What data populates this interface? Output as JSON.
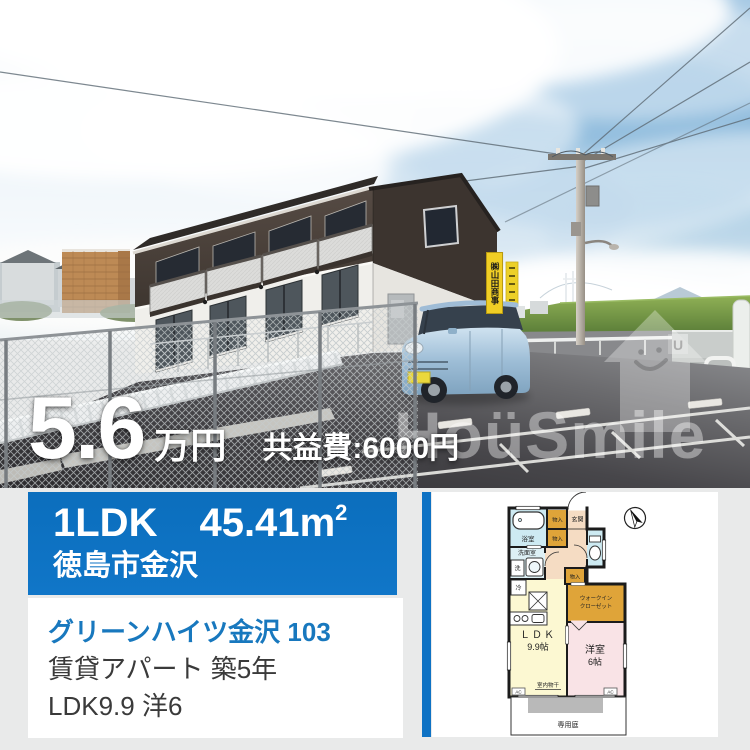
{
  "photo": {
    "price_value": "5.6",
    "price_unit": "万円",
    "fee_text": "共益費:6000円",
    "watermark_text": "HoüSmile",
    "watermark_logo_letter": "U",
    "sign_text": "㈱山田商事"
  },
  "info_box": {
    "layout": "1LDK",
    "area_value": "45.41",
    "area_unit_base": "m",
    "area_unit_sup": "2",
    "location": "徳島市金沢",
    "accent_color": "#0e72c4"
  },
  "details": {
    "name": "グリーンハイツ金沢 103",
    "type_age": "賃貸アパート 築5年",
    "rooms": "LDK9.9 洋6"
  },
  "floor_plan": {
    "labels": {
      "bath": "浴室",
      "storage1": "物入",
      "storage2": "物入",
      "storage3": "物入",
      "entrance": "玄関",
      "washroom": "洗面室",
      "washer": "洗",
      "fridge": "冷",
      "wic1": "ウォークイン",
      "wic2": "クローゼット",
      "ldk1": "ＬＤＫ",
      "ldk2": "9.9帖",
      "western1": "洋室",
      "western2": "6帖",
      "drying": "室内物干",
      "ac_left": "AC",
      "ac_right": "AC",
      "garden": "専用庭"
    },
    "colors": {
      "storage": "#dfa439",
      "wet_room": "#cdeaf2",
      "ldk": "#fcf8d2",
      "bedroom": "#f9e3e6",
      "hall": "#f5dcc3"
    }
  }
}
